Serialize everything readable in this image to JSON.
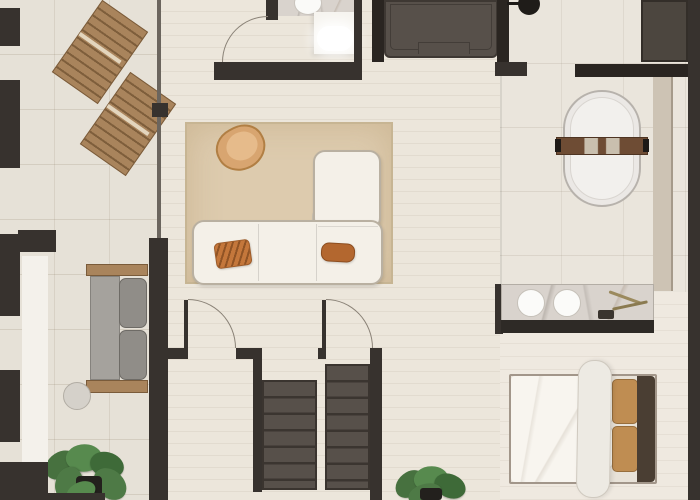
{
  "title": "Apartment floor plan (top-down render)",
  "palette": {
    "wall_dark": "#37322e",
    "wall_black": "#2a2521",
    "unit_gray": "#57504a",
    "floor_wood": "#ece6db",
    "floor_tile": "#e6e1d7",
    "floor_bath": "#eae5dc",
    "rug": "#ddcbae",
    "sofa": "#f4f0e8",
    "wood": "#a9845c",
    "tan_chair": "#d8a570",
    "pillow_orange": "#c4773b",
    "pillow_rust": "#b3672f",
    "bed_tan": "#bf8d52",
    "headboard": "#4a3e33",
    "plant_green": "#4e7a46",
    "marble": "#d9d3cd",
    "beige_wall": "#cdc3b4",
    "arc": "#8a8277"
  },
  "rooms": [
    {
      "name": "terrace",
      "features": [
        "sun-lounger",
        "sun-lounger",
        "outdoor-bench",
        "side-table",
        "monstera-plant"
      ]
    },
    {
      "name": "living-room",
      "features": [
        "area-rug",
        "sectional-sofa",
        "accent-armchair",
        "round-ottoman",
        "throw-pillows"
      ]
    },
    {
      "name": "wc",
      "features": [
        "toilet",
        "washbasin-counter",
        "door"
      ]
    },
    {
      "name": "bathroom",
      "features": [
        "freestanding-bathtub",
        "bath-caddy",
        "double-sink-vanity",
        "ceiling-fixture",
        "wardrobe",
        "cabinet-unit"
      ]
    },
    {
      "name": "bedroom",
      "features": [
        "double-bed",
        "headboard",
        "white-pillows",
        "tan-pillows",
        "potted-plant"
      ]
    },
    {
      "name": "hallway",
      "features": [
        "door",
        "door",
        "staircase-down",
        "staircase-down"
      ]
    }
  ],
  "counts": {
    "sun_loungers": 2,
    "staircases": 2,
    "door_arcs": 3,
    "vanity_sinks": 2,
    "plants": 2
  }
}
